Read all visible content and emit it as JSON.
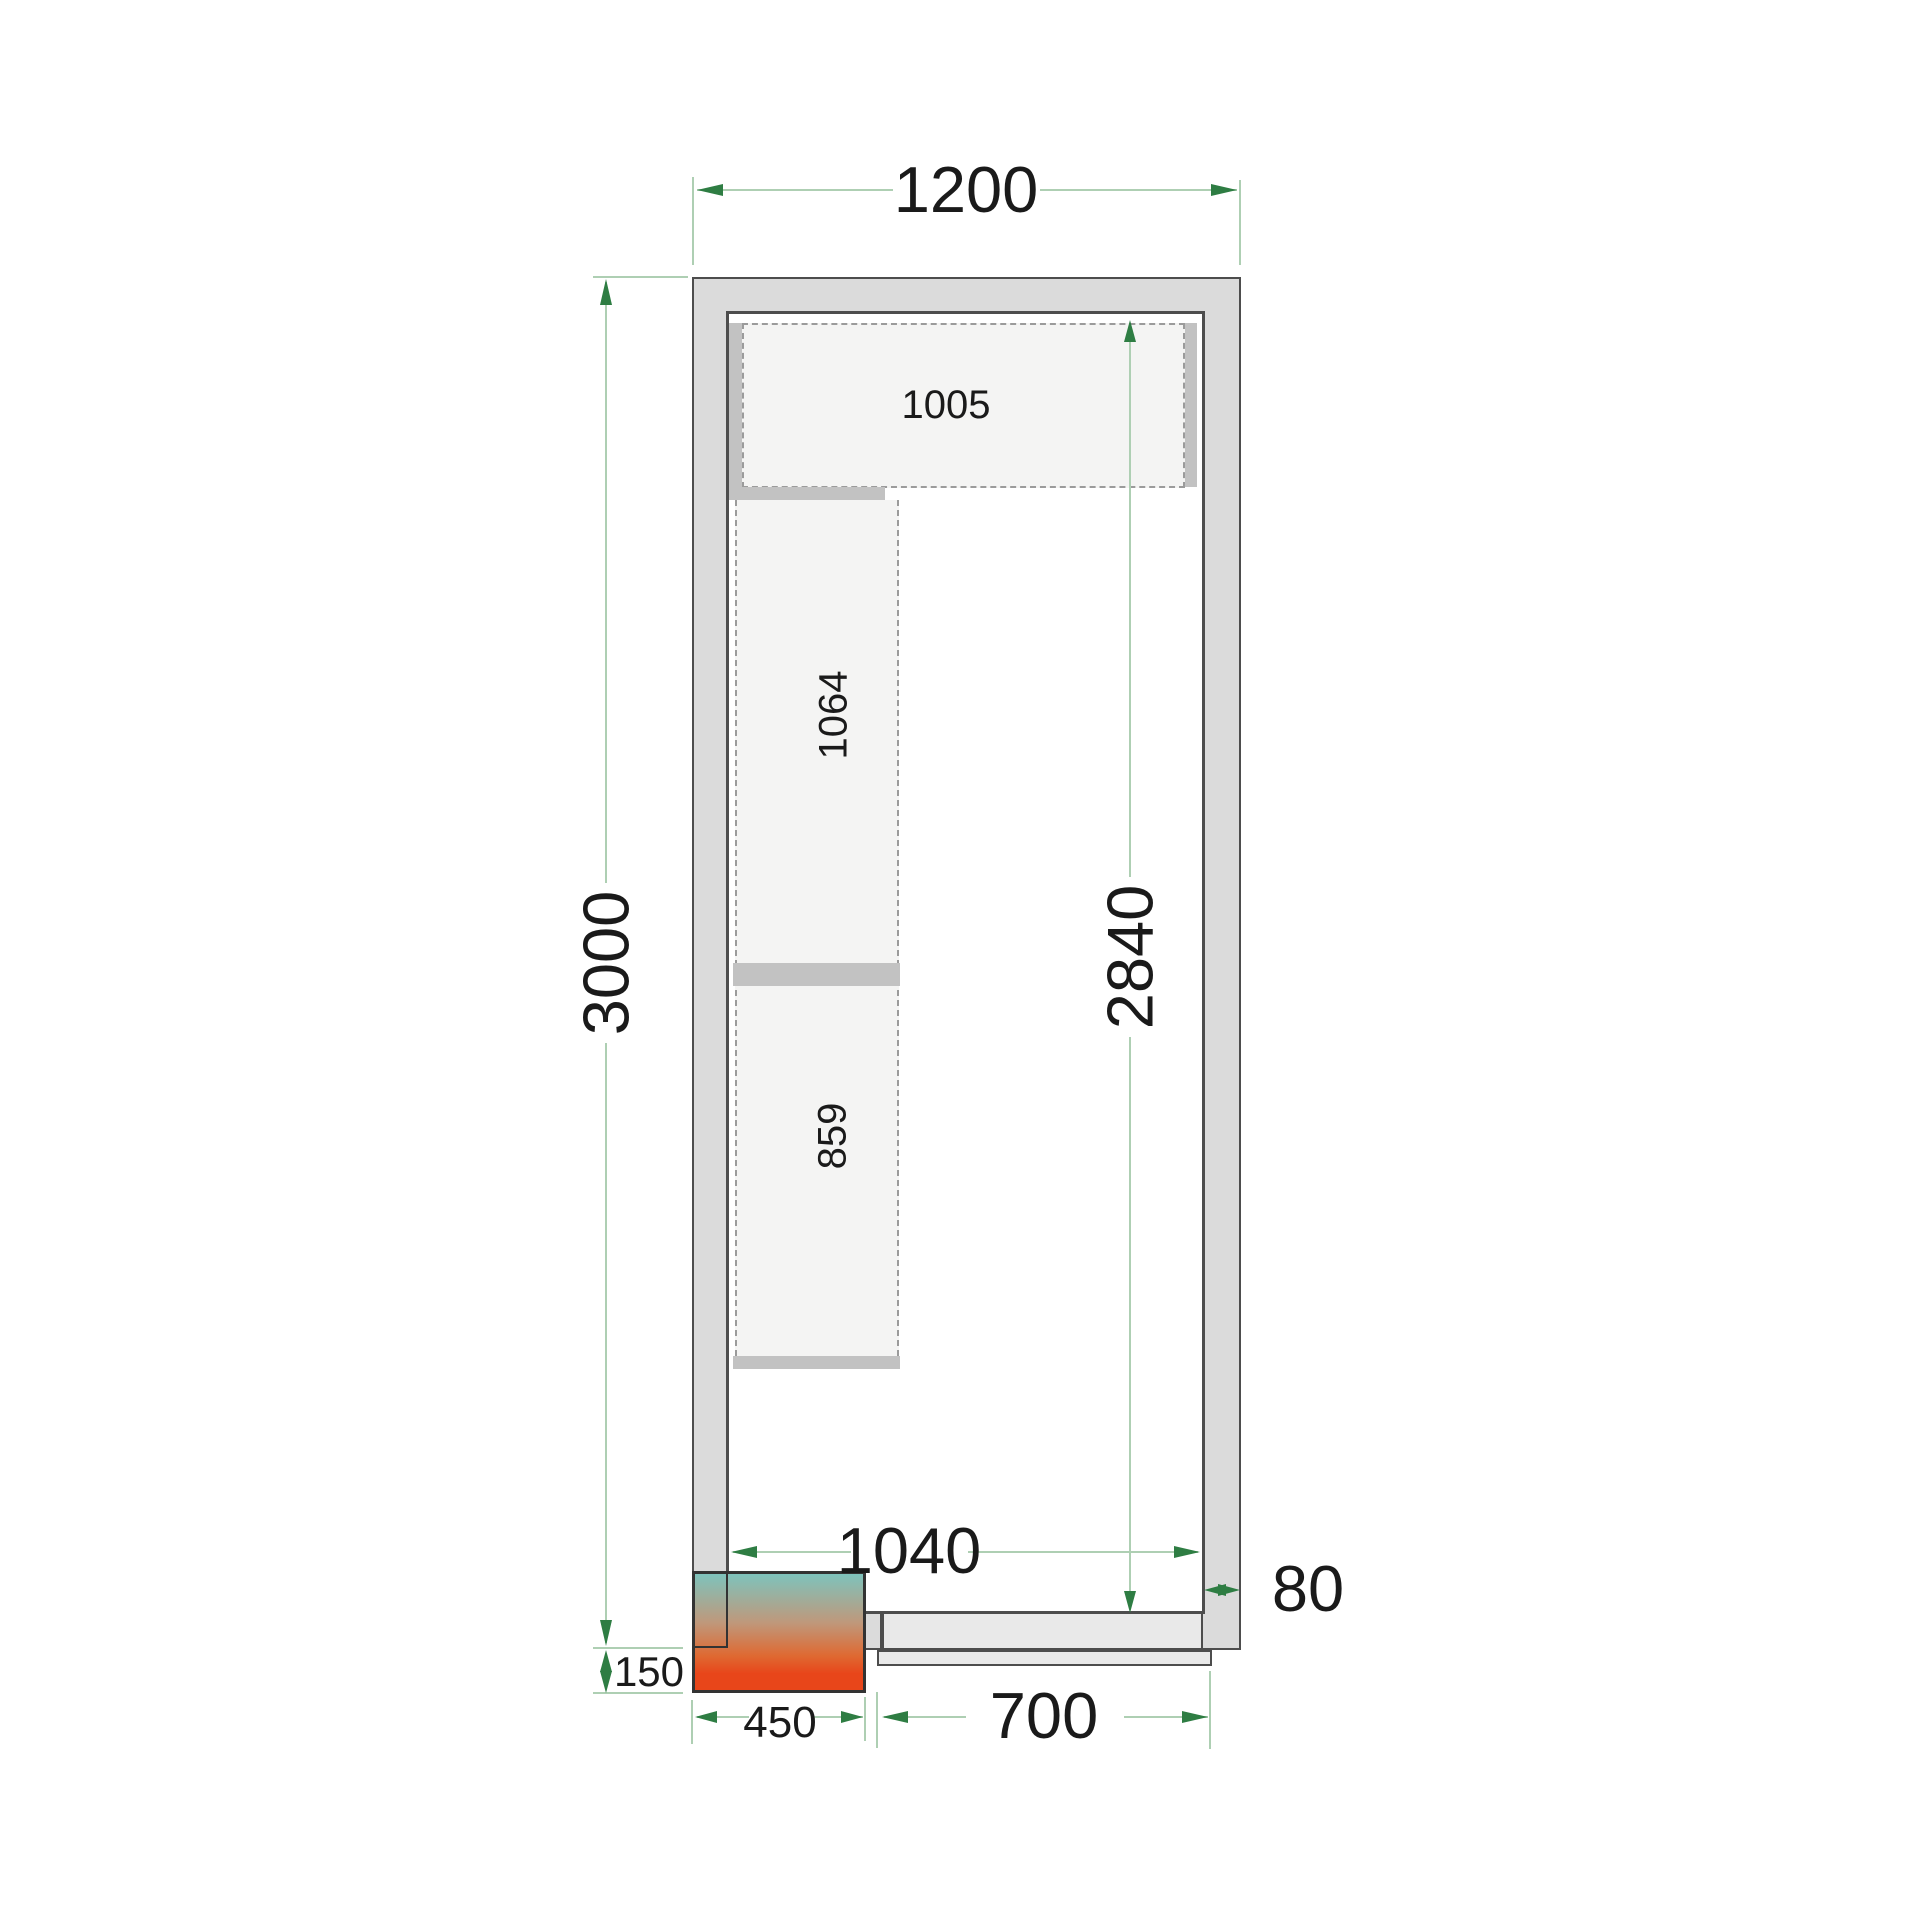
{
  "drawing": {
    "title": "cold-room-floor-plan",
    "dimensions": {
      "outer_width": "1200",
      "outer_length": "3000",
      "inner_length": "2840",
      "inner_width": "1040",
      "wall_thickness": "80",
      "unit_protrusion": "150",
      "unit_width": "450",
      "door_width": "700"
    },
    "shelves": {
      "top_shelf": "1005",
      "left_shelf_upper": "1064",
      "left_shelf_lower": "859"
    }
  },
  "colors": {
    "wall": "#dbdbdb",
    "wall-line": "#4d4d4d",
    "shelf": "#f4f4f3",
    "bracket": "#c2c2c2",
    "dash": "#9b9b9b",
    "door": "#e9e9e9",
    "dim-line": "#aecfb3",
    "dim-arrow": "#2e7d43",
    "text": "#1a1a1a",
    "unit-border": "#333333",
    "unit-teal": "#7ec3bc",
    "unit-tan": "#bf987b",
    "unit-orange": "#de6a33",
    "unit-red": "#e8461a"
  }
}
